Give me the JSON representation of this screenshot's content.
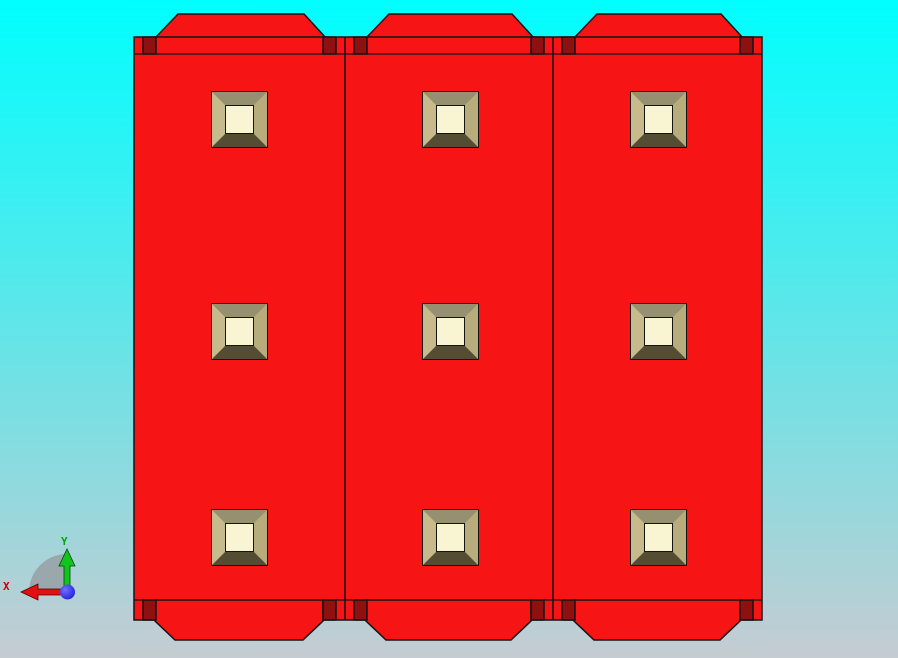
{
  "scene": {
    "description": "CAD viewport front view of three red panel modules, each with three beveled square bosses, chamfered mounting tabs top and bottom, and dark-red corner pegs",
    "background": {
      "top": "#00FEFE",
      "bottom": "#C5CCD2"
    }
  },
  "colors": {
    "body_red": "#F61414",
    "peg_dark_red": "#8E1111",
    "outline": "#141414",
    "bevel_top": "#968F70",
    "bevel_left": "#C7BB8D",
    "bevel_right": "#B9AC7C",
    "bevel_bottom": "#544D33",
    "boss_center": "#F9F4D2"
  },
  "model": {
    "body": {
      "x": 134,
      "y": 37,
      "width": 628,
      "height": 583
    },
    "lip_top_y": 54,
    "lip_bottom_y": 600,
    "panels": [
      {
        "left": 134,
        "right": 345
      },
      {
        "left": 345,
        "right": 553
      },
      {
        "left": 553,
        "right": 762
      }
    ],
    "boss_rows": [
      119,
      331,
      537
    ],
    "boss": {
      "size": 57,
      "bevel": 13,
      "center_offset_x": 105
    },
    "tabs": {
      "top": {
        "base_y": 38,
        "top_y": 14,
        "inset_base_l": 21,
        "inset_top_l": 44,
        "inset_top_r": 41,
        "inset_base_r": 19
      },
      "bottom": {
        "top_y": 600,
        "side_bottom_y": 621,
        "bottom_y": 640,
        "inset_side_l": 21,
        "inset_side_r": 22,
        "inset_bottom_l": 41,
        "inset_bottom_r": 42
      }
    },
    "pegs": {
      "width": 13,
      "inset": 9,
      "top": {
        "y": 37,
        "h": 17
      },
      "bottom": {
        "y": 600,
        "h": 20
      }
    }
  },
  "triad": {
    "x_label": "X",
    "y_label": "Y",
    "colors": {
      "x_axis": "#E01111",
      "y_axis": "#12C41E",
      "z_ball": "#1A1AD8",
      "z_ball_hi": "#7070FF",
      "shadow": "#96A0A5",
      "x_label": "#C80000",
      "y_label": "#00A80A"
    }
  }
}
